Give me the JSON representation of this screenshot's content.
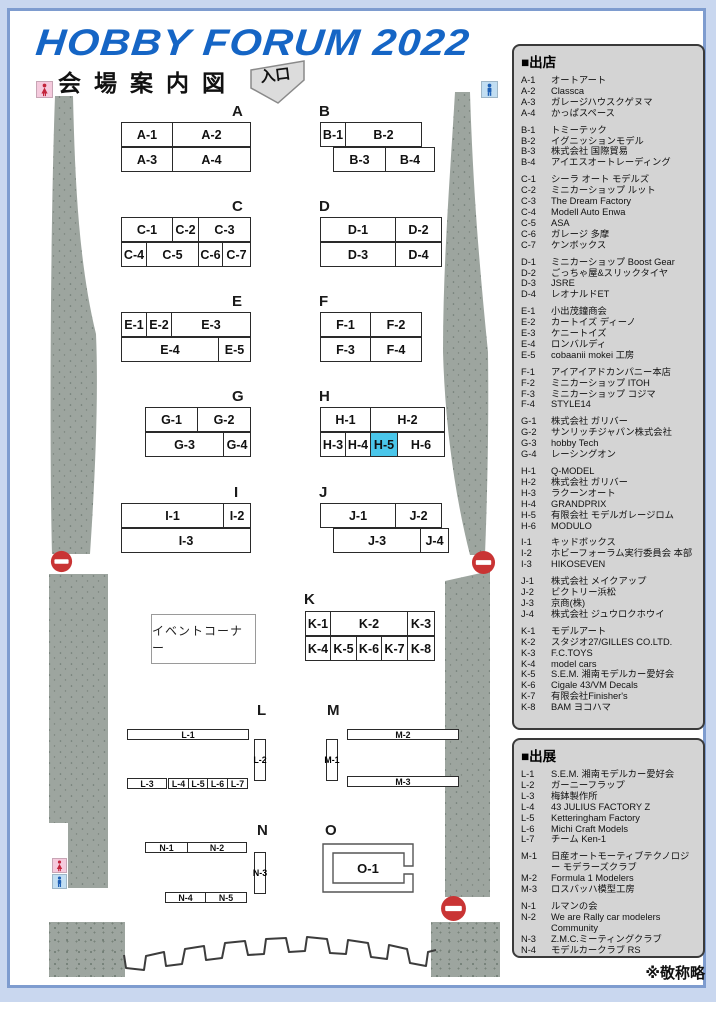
{
  "title": "HOBBY FORUM 2022",
  "subtitle": "会場案内図",
  "entrance_label": "入口",
  "event_corner_label": "イベントコーナー",
  "note": "※敬称略",
  "colors": {
    "title_blue": "#1565c5",
    "frame_blue": "#7e9ccf",
    "band_blue": "#c9d7ef",
    "legend_gray": "#d4d4d4",
    "pillar_gray": "#9da59f",
    "highlight_cyan": "#4ac6ea",
    "noentry_red": "#c93434",
    "female_red": "#c3233a",
    "male_blue": "#1e5fb5"
  },
  "icons": {
    "entrance_arrow": "down-arrow",
    "no_entry": "no-entry-circle",
    "restroom_female": "female-figure",
    "restroom_male": "male-figure"
  },
  "legend_shops": {
    "title": "■出店",
    "groups": [
      [
        [
          "A-1",
          "オートアート"
        ],
        [
          "A-2",
          "Classca"
        ],
        [
          "A-3",
          "ガレージハウスクゲヌマ"
        ],
        [
          "A-4",
          "かっぱスペース"
        ]
      ],
      [
        [
          "B-1",
          "トミーテック"
        ],
        [
          "B-2",
          "イグニッションモデル"
        ],
        [
          "B-3",
          "株式会社 国際貿易"
        ],
        [
          "B-4",
          "アイエスオートレーディング"
        ]
      ],
      [
        [
          "C-1",
          "シーラ オート モデルズ"
        ],
        [
          "C-2",
          "ミニカーショップ ルット"
        ],
        [
          "C-3",
          "The Dream Factory"
        ],
        [
          "C-4",
          "Modell Auto Enwa"
        ],
        [
          "C-5",
          "ASA"
        ],
        [
          "C-6",
          "ガレージ 多摩"
        ],
        [
          "C-7",
          "ケンボックス"
        ]
      ],
      [
        [
          "D-1",
          "ミニカーショップ Boost Gear"
        ],
        [
          "D-2",
          "ごっちゃ屋&スリックタイヤ"
        ],
        [
          "D-3",
          "JSRE"
        ],
        [
          "D-4",
          "レオナルドET"
        ]
      ],
      [
        [
          "E-1",
          "小出茂鐘商会"
        ],
        [
          "E-2",
          "カートイズ ディーノ"
        ],
        [
          "E-3",
          "ケニートイズ"
        ],
        [
          "E-4",
          "ロンバルディ"
        ],
        [
          "E-5",
          "cobaanii mokei 工房"
        ]
      ],
      [
        [
          "F-1",
          "アイアイアドカンパニー本店"
        ],
        [
          "F-2",
          "ミニカーショップ ITOH"
        ],
        [
          "F-3",
          "ミニカーショップ コジマ"
        ],
        [
          "F-4",
          "STYLE14"
        ]
      ],
      [
        [
          "G-1",
          "株式会社 ガリバー"
        ],
        [
          "G-2",
          "サンリッチジャパン株式会社"
        ],
        [
          "G-3",
          "hobby Tech"
        ],
        [
          "G-4",
          "レーシングオン"
        ]
      ],
      [
        [
          "H-1",
          "Q-MODEL"
        ],
        [
          "H-2",
          "株式会社 ガリバー"
        ],
        [
          "H-3",
          "ラクーンオート"
        ],
        [
          "H-4",
          "GRANDPRIX"
        ],
        [
          "H-5",
          "有限会社 モデルガレージロム"
        ],
        [
          "H-6",
          "MODULO"
        ]
      ],
      [
        [
          "I-1",
          "キッドボックス"
        ],
        [
          "I-2",
          "ホビーフォーラム実行委員会 本部"
        ],
        [
          "I-3",
          "HIKOSEVEN"
        ]
      ],
      [
        [
          "J-1",
          "株式会社 メイクアップ"
        ],
        [
          "J-2",
          "ビクトリー浜松"
        ],
        [
          "J-3",
          "京商(株)"
        ],
        [
          "J-4",
          "株式会社 ジュウロクホウイ"
        ]
      ],
      [
        [
          "K-1",
          "モデルアート"
        ],
        [
          "K-2",
          "スタジオ27/GILLES CO.LTD."
        ],
        [
          "K-3",
          "F.C.TOYS"
        ],
        [
          "K-4",
          "model cars"
        ],
        [
          "K-5",
          "S.E.M. 湘南モデルカー愛好会"
        ],
        [
          "K-6",
          "Cigale 43/VM Decals"
        ],
        [
          "K-7",
          "有限会社Finisher's"
        ],
        [
          "K-8",
          "BAM ヨコハマ"
        ]
      ]
    ]
  },
  "legend_exhibits": {
    "title": "■出展",
    "groups": [
      [
        [
          "L-1",
          "S.E.M. 湘南モデルカー愛好会"
        ],
        [
          "L-2",
          "ガーニーフラップ"
        ],
        [
          "L-3",
          "梅鉢製作所"
        ],
        [
          "L-4",
          "43 JULIUS FACTORY Z"
        ],
        [
          "L-5",
          "Ketteringham Factory"
        ],
        [
          "L-6",
          "Michi Craft Models"
        ],
        [
          "L-7",
          "チーム Ken-1"
        ]
      ],
      [
        [
          "M-1",
          "日産オートモーティブテクノロジー モデラーズクラブ"
        ],
        [
          "M-2",
          "Formula 1 Modelers"
        ],
        [
          "M-3",
          "ロスバッハ模型工房"
        ]
      ],
      [
        [
          "N-1",
          "ルマンの会"
        ],
        [
          "N-2",
          "We are Rally car modelers Community"
        ],
        [
          "N-3",
          "Z.M.C.ミーティングクラブ"
        ],
        [
          "N-4",
          "モデルカークラブ RS"
        ],
        [
          "N-5",
          "くるま村少年団"
        ]
      ],
      [
        [
          "O-1",
          "M.I models"
        ]
      ]
    ]
  },
  "map": {
    "o1_label": "O-1",
    "blocks": [
      {
        "label": "A",
        "label_x": 232,
        "label_y": 103,
        "rows": [
          {
            "x": 121,
            "y": 122,
            "h": 25,
            "cells": [
              {
                "t": "A-1",
                "w": 51
              },
              {
                "t": "A-2",
                "w": 77
              }
            ]
          },
          {
            "x": 121,
            "y": 147,
            "h": 25,
            "cells": [
              {
                "t": "A-3",
                "w": 51
              },
              {
                "t": "A-4",
                "w": 77
              }
            ]
          }
        ]
      },
      {
        "label": "B",
        "label_x": 319,
        "label_y": 103,
        "rows": [
          {
            "x": 320,
            "y": 122,
            "h": 25,
            "cells": [
              {
                "t": "B-1",
                "w": 25
              },
              {
                "t": "B-2",
                "w": 75
              }
            ]
          },
          {
            "x": 333,
            "y": 147,
            "h": 25,
            "cells": [
              {
                "t": "B-3",
                "w": 52
              },
              {
                "t": "B-4",
                "w": 48
              }
            ]
          }
        ]
      },
      {
        "label": "C",
        "label_x": 232,
        "label_y": 198,
        "rows": [
          {
            "x": 121,
            "y": 217,
            "h": 25,
            "cells": [
              {
                "t": "C-1",
                "w": 51
              },
              {
                "t": "C-2",
                "w": 26
              },
              {
                "t": "C-3",
                "w": 51
              }
            ]
          },
          {
            "x": 121,
            "y": 242,
            "h": 25,
            "cells": [
              {
                "t": "C-4",
                "w": 25
              },
              {
                "t": "C-5",
                "w": 52
              },
              {
                "t": "C-6",
                "w": 24
              },
              {
                "t": "C-7",
                "w": 27
              }
            ]
          }
        ]
      },
      {
        "label": "D",
        "label_x": 319,
        "label_y": 198,
        "rows": [
          {
            "x": 320,
            "y": 217,
            "h": 25,
            "cells": [
              {
                "t": "D-1",
                "w": 75
              },
              {
                "t": "D-2",
                "w": 45
              }
            ]
          },
          {
            "x": 320,
            "y": 242,
            "h": 25,
            "cells": [
              {
                "t": "D-3",
                "w": 75
              },
              {
                "t": "D-4",
                "w": 45
              }
            ]
          }
        ]
      },
      {
        "label": "E",
        "label_x": 232,
        "label_y": 293,
        "rows": [
          {
            "x": 121,
            "y": 312,
            "h": 25,
            "cells": [
              {
                "t": "E-1",
                "w": 25
              },
              {
                "t": "E-2",
                "w": 25
              },
              {
                "t": "E-3",
                "w": 78
              }
            ]
          },
          {
            "x": 121,
            "y": 337,
            "h": 25,
            "cells": [
              {
                "t": "E-4",
                "w": 97
              },
              {
                "t": "E-5",
                "w": 31
              }
            ]
          }
        ]
      },
      {
        "label": "F",
        "label_x": 319,
        "label_y": 293,
        "rows": [
          {
            "x": 320,
            "y": 312,
            "h": 25,
            "cells": [
              {
                "t": "F-1",
                "w": 50
              },
              {
                "t": "F-2",
                "w": 50
              }
            ]
          },
          {
            "x": 320,
            "y": 337,
            "h": 25,
            "cells": [
              {
                "t": "F-3",
                "w": 50
              },
              {
                "t": "F-4",
                "w": 50
              }
            ]
          }
        ]
      },
      {
        "label": "G",
        "label_x": 232,
        "label_y": 388,
        "rows": [
          {
            "x": 145,
            "y": 407,
            "h": 25,
            "cells": [
              {
                "t": "G-1",
                "w": 52
              },
              {
                "t": "G-2",
                "w": 52
              }
            ]
          },
          {
            "x": 145,
            "y": 432,
            "h": 25,
            "cells": [
              {
                "t": "G-3",
                "w": 78
              },
              {
                "t": "G-4",
                "w": 26
              }
            ]
          }
        ]
      },
      {
        "label": "H",
        "label_x": 319,
        "label_y": 388,
        "rows": [
          {
            "x": 320,
            "y": 407,
            "h": 25,
            "cells": [
              {
                "t": "H-1",
                "w": 50
              },
              {
                "t": "H-2",
                "w": 73
              }
            ]
          },
          {
            "x": 320,
            "y": 432,
            "h": 25,
            "cells": [
              {
                "t": "H-3",
                "w": 25
              },
              {
                "t": "H-4",
                "w": 25
              },
              {
                "t": "H-5",
                "w": 27,
                "hl": true
              },
              {
                "t": "H-6",
                "w": 46
              }
            ]
          }
        ]
      },
      {
        "label": "I",
        "label_x": 234,
        "label_y": 484,
        "rows": [
          {
            "x": 121,
            "y": 503,
            "h": 25,
            "cells": [
              {
                "t": "I-1",
                "w": 102
              },
              {
                "t": "I-2",
                "w": 26
              }
            ]
          },
          {
            "x": 121,
            "y": 528,
            "h": 25,
            "cells": [
              {
                "t": "I-3",
                "w": 128
              }
            ]
          }
        ]
      },
      {
        "label": "J",
        "label_x": 319,
        "label_y": 484,
        "rows": [
          {
            "x": 320,
            "y": 503,
            "h": 25,
            "cells": [
              {
                "t": "J-1",
                "w": 75
              },
              {
                "t": "J-2",
                "w": 45
              }
            ]
          },
          {
            "x": 333,
            "y": 528,
            "h": 25,
            "cells": [
              {
                "t": "J-3",
                "w": 87
              },
              {
                "t": "J-4",
                "w": 27
              }
            ]
          }
        ]
      },
      {
        "label": "K",
        "label_x": 304,
        "label_y": 591,
        "rows": [
          {
            "x": 305,
            "y": 611,
            "h": 25,
            "cells": [
              {
                "t": "K-1",
                "w": 25
              },
              {
                "t": "K-2",
                "w": 77
              },
              {
                "t": "K-3",
                "w": 26
              }
            ]
          },
          {
            "x": 305,
            "y": 636,
            "h": 25,
            "cells": [
              {
                "t": "K-4",
                "w": 25
              },
              {
                "t": "K-5",
                "w": 26
              },
              {
                "t": "K-6",
                "w": 25
              },
              {
                "t": "K-7",
                "w": 26
              },
              {
                "t": "K-8",
                "w": 26
              }
            ]
          }
        ]
      }
    ],
    "thin_rows": [
      {
        "x": 127,
        "y": 729,
        "h": 11,
        "cells": [
          {
            "t": "L-1",
            "w": 120
          }
        ]
      },
      {
        "x": 127,
        "y": 778,
        "h": 11,
        "cells": [
          {
            "t": "L-3",
            "w": 38
          }
        ]
      },
      {
        "x": 168,
        "y": 778,
        "h": 11,
        "cells": [
          {
            "t": "L-4",
            "w": 20
          },
          {
            "t": "L-5",
            "w": 19
          },
          {
            "t": "L-6",
            "w": 20
          },
          {
            "t": "L-7",
            "w": 19
          }
        ]
      },
      {
        "x": 347,
        "y": 729,
        "h": 11,
        "cells": [
          {
            "t": "M-2",
            "w": 110
          }
        ]
      },
      {
        "x": 347,
        "y": 776,
        "h": 11,
        "cells": [
          {
            "t": "M-3",
            "w": 110
          }
        ]
      },
      {
        "x": 145,
        "y": 842,
        "h": 11,
        "cells": [
          {
            "t": "N-1",
            "w": 42
          },
          {
            "t": "N-2",
            "w": 58
          }
        ]
      },
      {
        "x": 165,
        "y": 892,
        "h": 11,
        "cells": [
          {
            "t": "N-4",
            "w": 40
          },
          {
            "t": "N-5",
            "w": 40
          }
        ]
      }
    ],
    "vtabs": [
      {
        "t": "L-2",
        "x": 254,
        "y": 739,
        "w": 12,
        "h": 42
      },
      {
        "t": "M-1",
        "x": 326,
        "y": 739,
        "w": 12,
        "h": 42
      },
      {
        "t": "N-3",
        "x": 254,
        "y": 852,
        "w": 12,
        "h": 42
      }
    ],
    "section_labels": [
      {
        "t": "L",
        "x": 257,
        "y": 702
      },
      {
        "t": "M",
        "x": 327,
        "y": 702
      },
      {
        "t": "N",
        "x": 257,
        "y": 822
      },
      {
        "t": "O",
        "x": 325,
        "y": 822
      }
    ]
  }
}
